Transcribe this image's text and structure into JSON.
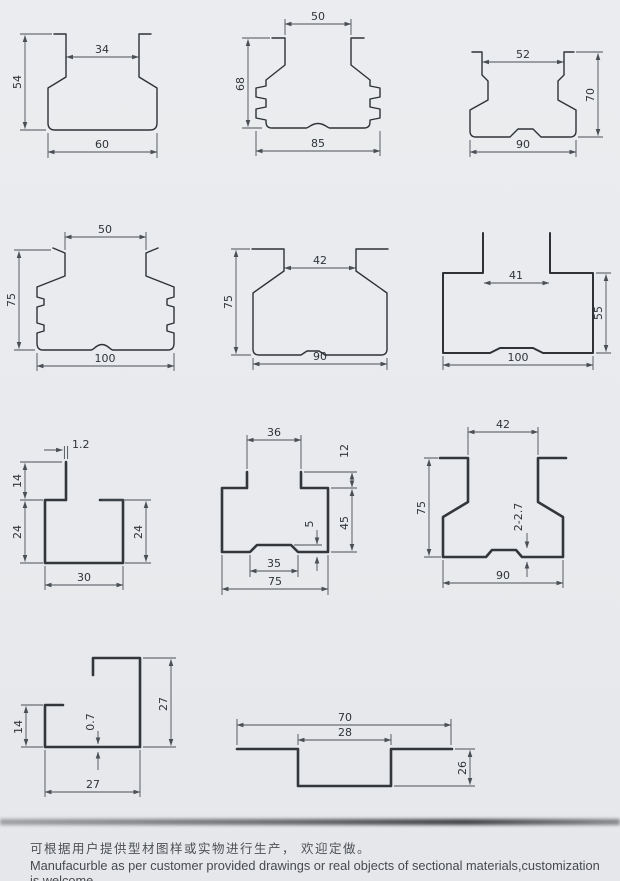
{
  "page": {
    "background": "#e8eaed",
    "line_color": "#2e3237"
  },
  "footer": {
    "caption_zh": "可根据用户提供型材图样或实物进行生产， 欢迎定做。",
    "caption_en": "Manufacurble as per customer provided drawings or real objects of sectional materials,customization is welcome."
  },
  "diagrams": [
    {
      "id": "hat-profile-60x54",
      "dims": {
        "top_inner": "34",
        "height": "54",
        "bottom": "60"
      }
    },
    {
      "id": "ribbed-hat-profile-85x68",
      "dims": {
        "top_inner": "50",
        "height": "68",
        "bottom": "85"
      }
    },
    {
      "id": "hat-profile-90x70",
      "dims": {
        "top_inner": "52",
        "height": "70",
        "bottom": "90"
      }
    },
    {
      "id": "ribbed-hat-profile-100x75",
      "dims": {
        "top_inner": "50",
        "height": "75",
        "bottom": "100"
      }
    },
    {
      "id": "hat-profile-90x75",
      "dims": {
        "top_inner": "42",
        "height": "75",
        "bottom": "90"
      }
    },
    {
      "id": "open-box-profile-100x55",
      "dims": {
        "top_inner": "41",
        "height": "55",
        "bottom": "100"
      }
    },
    {
      "id": "c-channel-30x24",
      "dims": {
        "stem_thickness": "1.2",
        "stem_height": "14",
        "left_height": "24",
        "right_height": "24",
        "bottom": "30"
      }
    },
    {
      "id": "box-profile-75x45",
      "dims": {
        "top_inner": "36",
        "stem_height": "12",
        "height": "45",
        "bump_height": "5",
        "bump_width": "35",
        "bottom": "75"
      }
    },
    {
      "id": "hat-profile-90x75-thick",
      "dims": {
        "top_inner": "42",
        "height": "75",
        "thickness": "2-2.7",
        "bottom": "90"
      }
    },
    {
      "id": "j-channel-27x27",
      "dims": {
        "left_height": "14",
        "thickness": "0.7",
        "right_height": "27",
        "bottom": "27"
      }
    },
    {
      "id": "recessed-channel-70x26",
      "dims": {
        "overall_width": "70",
        "channel_width": "28",
        "depth": "26"
      }
    }
  ]
}
